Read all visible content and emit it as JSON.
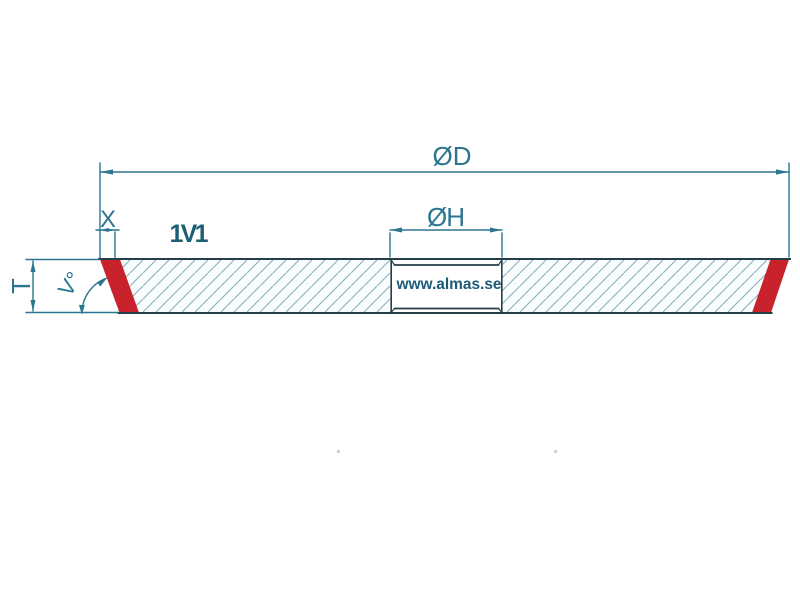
{
  "drawing": {
    "labels": {
      "outer_diameter": "ØD",
      "hole_diameter": "ØH",
      "edge_width": "X",
      "wheel_type": "1V1",
      "thickness": "T",
      "bevel_angle": "V°",
      "watermark": "www.almas.se"
    },
    "colors": {
      "dimension": "#2b7590",
      "outline": "#243d46",
      "bold_label": "#1c5f76",
      "watermark": "#1d5a7a",
      "hatch": "#8ab0bb",
      "body_fill": "#f9fdfe",
      "bevel_red": "#c8232d",
      "background": "#ffffff"
    }
  }
}
